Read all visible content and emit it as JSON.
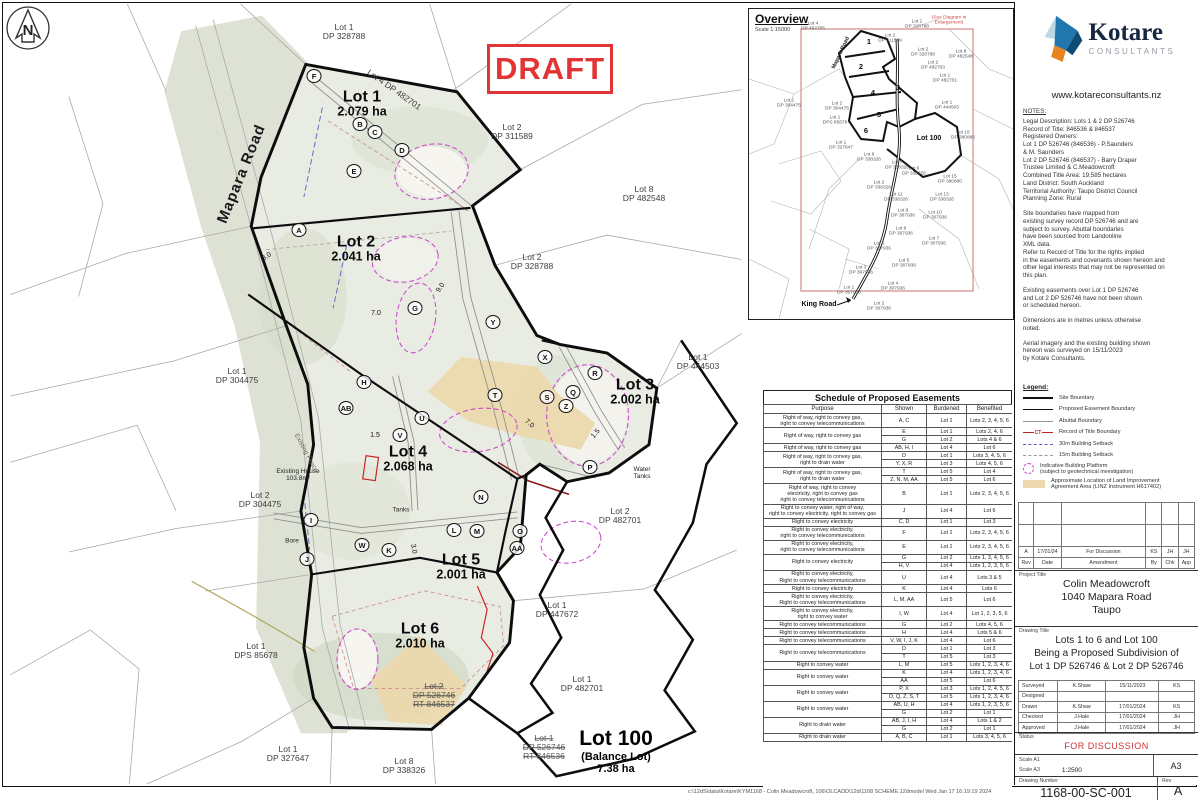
{
  "draft_stamp": "DRAFT",
  "map": {
    "footer_path": "c:\\12dS\\data\\Kotare\\KYM1168 - Colin Meadowcroft, 106\\OLCADD\\12d\\1168 SCHEME.12dmodel   Wed Jan 17 16:19:19 2024",
    "labels": [
      {
        "t": "Lot 1",
        "s": "DP 328788",
        "c": "parcel",
        "x": 340,
        "y": 28
      },
      {
        "t": "Lot 4 DP 482701",
        "c": "edge",
        "x": 390,
        "y": 86,
        "r": 35
      },
      {
        "t": "Lot 1",
        "s": "2.079 ha",
        "c": "lot",
        "x": 358,
        "y": 100
      },
      {
        "t": "Mapara Road",
        "c": "road",
        "x": 238,
        "y": 170,
        "r": -68
      },
      {
        "t": "Lot 2",
        "s": "DP 311589",
        "c": "parcel",
        "x": 508,
        "y": 128
      },
      {
        "t": "Lot 8",
        "s": "DP 482548",
        "c": "parcel",
        "x": 640,
        "y": 190
      },
      {
        "t": "Lot 2",
        "s": "2.041 ha",
        "c": "lot",
        "x": 352,
        "y": 245
      },
      {
        "t": "Lot 2",
        "s": "DP 328788",
        "c": "parcel",
        "x": 528,
        "y": 258
      },
      {
        "t": "Lot 1",
        "s": "DP 304475",
        "c": "parcel",
        "x": 233,
        "y": 372
      },
      {
        "t": "Lot 3",
        "s": "2.002 ha",
        "c": "lot",
        "x": 631,
        "y": 388
      },
      {
        "t": "Lot 1",
        "s": "DP 444503",
        "c": "parcel",
        "x": 694,
        "y": 358
      },
      {
        "t": "Lot 4",
        "s": "2.068 ha",
        "c": "lot",
        "x": 404,
        "y": 455
      },
      {
        "t": "Existing House",
        "s": "103.8m²",
        "c": "tiny",
        "x": 294,
        "y": 471
      },
      {
        "t": "Lot 2",
        "s": "DP 304475",
        "c": "parcel",
        "x": 256,
        "y": 496
      },
      {
        "t": "Water",
        "s": "Tanks",
        "c": "tiny",
        "x": 638,
        "y": 469
      },
      {
        "t": "Lot 2",
        "s": "DP 482701",
        "c": "parcel",
        "x": 616,
        "y": 512
      },
      {
        "t": "Tanks",
        "c": "tiny",
        "x": 397,
        "y": 506
      },
      {
        "t": "Bore",
        "c": "tiny",
        "x": 288,
        "y": 537
      },
      {
        "t": "Lot 5",
        "s": "2.001 ha",
        "c": "lot",
        "x": 457,
        "y": 563
      },
      {
        "t": "Lot 1",
        "s": "DP 447672",
        "c": "parcel",
        "x": 553,
        "y": 606
      },
      {
        "t": "Lot 6",
        "s": "2.010 ha",
        "c": "lot",
        "x": 416,
        "y": 632
      },
      {
        "t": "Lot 1",
        "s": "DPS 85678",
        "c": "parcel",
        "x": 252,
        "y": 647
      },
      {
        "t": "Lot 2",
        "s": "DP 526746\nRT 846537",
        "c": "strike",
        "x": 430,
        "y": 692
      },
      {
        "t": "Lot 1",
        "s": "DP 482701",
        "c": "parcel",
        "x": 578,
        "y": 680
      },
      {
        "t": "Lot 1",
        "s": "DP 526746\nRT 846536",
        "c": "strike",
        "x": 540,
        "y": 744
      },
      {
        "t": "Lot 100",
        "s": "(Balance Lot)\n7.38 ha",
        "c": "lot100",
        "x": 612,
        "y": 748
      },
      {
        "t": "Lot 1",
        "s": "DP 327647",
        "c": "parcel",
        "x": 284,
        "y": 750
      },
      {
        "t": "Lot 8",
        "s": "DP 338326",
        "c": "parcel",
        "x": 400,
        "y": 762
      },
      {
        "t": "Existing Fence",
        "c": "fence",
        "x": 302,
        "y": 449,
        "r": 62
      },
      {
        "t": "8.0",
        "c": "dim",
        "x": 263,
        "y": 253,
        "r": -35
      },
      {
        "t": "9.0",
        "c": "dim",
        "x": 437,
        "y": 284,
        "r": -55
      },
      {
        "t": "7.0",
        "c": "dim",
        "x": 372,
        "y": 310
      },
      {
        "t": "7.0",
        "c": "dim",
        "x": 525,
        "y": 420,
        "r": 40
      },
      {
        "t": "1.5",
        "c": "dim",
        "x": 371,
        "y": 432
      },
      {
        "t": "1.5",
        "c": "dim",
        "x": 592,
        "y": 430,
        "r": -50
      },
      {
        "t": "3.0",
        "c": "dim",
        "x": 409,
        "y": 545,
        "r": 80
      }
    ],
    "markers": [
      [
        "F",
        310,
        72
      ],
      [
        "B",
        356,
        120
      ],
      [
        "C",
        371,
        128
      ],
      [
        "D",
        398,
        146
      ],
      [
        "E",
        350,
        167
      ],
      [
        "A",
        295,
        226
      ],
      [
        "G",
        411,
        304
      ],
      [
        "Y",
        489,
        318
      ],
      [
        "X",
        541,
        353
      ],
      [
        "R",
        591,
        369
      ],
      [
        "Q",
        569,
        388
      ],
      [
        "S",
        543,
        393
      ],
      [
        "Z",
        562,
        402
      ],
      [
        "H",
        360,
        378
      ],
      [
        "AB",
        342,
        404
      ],
      [
        "U",
        418,
        414
      ],
      [
        "V",
        396,
        431
      ],
      [
        "T",
        491,
        391
      ],
      [
        "P",
        586,
        463
      ],
      [
        "I",
        307,
        516
      ],
      [
        "W",
        358,
        541
      ],
      [
        "K",
        385,
        546
      ],
      [
        "L",
        450,
        526
      ],
      [
        "M",
        473,
        527
      ],
      [
        "N",
        477,
        493
      ],
      [
        "O",
        516,
        527
      ],
      [
        "AA",
        513,
        544
      ],
      [
        "J",
        303,
        555
      ]
    ]
  },
  "overview": {
    "title": "Overview",
    "scale": "Scale 1:15000",
    "labels": [
      {
        "t": "(See Diagram in Enlargement)",
        "x": 200,
        "y": 12,
        "c": "red"
      },
      {
        "t": "Lot 4\nDP 482705",
        "x": 64,
        "y": 18
      },
      {
        "t": "Lot 1\nDP 328788",
        "x": 168,
        "y": 16
      },
      {
        "t": "Lot 2\nDP 311589",
        "x": 141,
        "y": 30
      },
      {
        "t": "Lot 2\nDP 328788",
        "x": 174,
        "y": 44
      },
      {
        "t": "Lot 8\nDP 482548",
        "x": 212,
        "y": 46
      },
      {
        "t": "Lot 2\nDP 482703",
        "x": 184,
        "y": 57
      },
      {
        "t": "Lot 1\nDP 482701",
        "x": 196,
        "y": 70
      },
      {
        "t": "Mapara Road",
        "x": 92,
        "y": 44,
        "r": -65,
        "c": "roadsm"
      },
      {
        "t": "Lot 1\nDP 304475",
        "x": 40,
        "y": 95
      },
      {
        "t": "Lot 2\nDP 304475",
        "x": 88,
        "y": 98
      },
      {
        "t": "Lot 1\nDP 444503",
        "x": 198,
        "y": 97
      },
      {
        "t": "Lot 1\nDPS 85678",
        "x": 86,
        "y": 112
      },
      {
        "t": "Lot 100",
        "x": 180,
        "y": 130,
        "c": "bold"
      },
      {
        "t": "Lot 15\nDP 380880",
        "x": 214,
        "y": 127
      },
      {
        "t": "Lot 1\nDP 327647",
        "x": 92,
        "y": 137
      },
      {
        "t": "Lot 8\nDP 338326",
        "x": 120,
        "y": 149
      },
      {
        "t": "Lot 7\nDP 338326",
        "x": 148,
        "y": 157
      },
      {
        "t": "Lot 6\nDP 338326",
        "x": 165,
        "y": 163
      },
      {
        "t": "Lot 15\nDP 380880",
        "x": 201,
        "y": 171
      },
      {
        "t": "Lot 2\nDP 338326",
        "x": 130,
        "y": 177
      },
      {
        "t": "Lot 11\nDP 338326",
        "x": 147,
        "y": 189
      },
      {
        "t": "Lot 13\nDP 338326",
        "x": 193,
        "y": 189
      },
      {
        "t": "Lot 9\nDP 307936",
        "x": 154,
        "y": 205
      },
      {
        "t": "Lot 10\nDP 307936",
        "x": 186,
        "y": 207
      },
      {
        "t": "Lot 8\nDP 307936",
        "x": 152,
        "y": 223
      },
      {
        "t": "Lot 7\nDP 307936",
        "x": 185,
        "y": 233
      },
      {
        "t": "Lot 6\nDP 307936",
        "x": 130,
        "y": 238
      },
      {
        "t": "Lot 5\nDP 307936",
        "x": 155,
        "y": 255
      },
      {
        "t": "Lot 3\nDP 307936",
        "x": 112,
        "y": 262
      },
      {
        "t": "Lot 4\nDP 307936",
        "x": 144,
        "y": 278
      },
      {
        "t": "Lot 1\nDP 307936",
        "x": 100,
        "y": 282
      },
      {
        "t": "Lot 2\nDP 307936",
        "x": 130,
        "y": 298
      },
      {
        "t": "King Road",
        "x": 70,
        "y": 296,
        "c": "bold"
      },
      {
        "t": "1",
        "x": 120,
        "y": 33,
        "c": "num"
      },
      {
        "t": "2",
        "x": 112,
        "y": 58,
        "c": "num"
      },
      {
        "t": "3",
        "x": 149,
        "y": 79,
        "c": "num"
      },
      {
        "t": "4",
        "x": 124,
        "y": 84,
        "c": "num"
      },
      {
        "t": "5",
        "x": 130,
        "y": 106,
        "c": "num"
      },
      {
        "t": "6",
        "x": 117,
        "y": 122,
        "c": "num"
      }
    ]
  },
  "easements": {
    "title": "Schedule of Proposed Easements",
    "columns": [
      "Purpose",
      "Shown",
      "Burdened",
      "Benefited"
    ],
    "groups": [
      {
        "purpose": "Right of way, right to convey gas,\nright to convey telecommunications",
        "rows": [
          [
            "A, C",
            "Lot 1",
            "Lots 2, 3, 4, 5, 6"
          ]
        ]
      },
      {
        "purpose": "Right of way, right to convey gas",
        "rows": [
          [
            "E",
            "Lot 1",
            "Lots 2, 4, 6"
          ],
          [
            "G",
            "Lot 2",
            "Lots 4 & 6"
          ]
        ]
      },
      {
        "purpose": "Right of way, right to convey gas",
        "rows": [
          [
            "AB, H, I",
            "Lot 4",
            "Lot 6"
          ]
        ]
      },
      {
        "purpose": "Right of way, right to convey gas,\nright to drain water",
        "rows": [
          [
            "D",
            "Lot 1",
            "Lots 3, 4, 5, 6"
          ],
          [
            "Y, X, R",
            "Lot 3",
            "Lots 4, 5, 6"
          ]
        ]
      },
      {
        "purpose": "Right of way, right to convey gas,\nright to drain water",
        "rows": [
          [
            "T",
            "Lot 5",
            "Lot 4"
          ],
          [
            "Z, N, M, AA",
            "Lot 5",
            "Lot 6"
          ]
        ]
      },
      {
        "purpose": "Right of way, right to convey\nelectricity, right to convey gas\nright to convey telecommunications",
        "rows": [
          [
            "B",
            "Lot 1",
            "Lots 2, 3, 4, 5, 6"
          ]
        ]
      },
      {
        "purpose": "Right to convey water, right of way,\nright to convey electricity, right to convey gas",
        "rows": [
          [
            "J",
            "Lot 4",
            "Lot 6"
          ]
        ]
      },
      {
        "purpose": "Right to convey electricity",
        "rows": [
          [
            "C, D",
            "Lot 1",
            "Lot 3"
          ]
        ]
      },
      {
        "purpose": "Right to convey electricity,\nright to convey telecommunications",
        "rows": [
          [
            "F",
            "Lot 1",
            "Lots 2, 3, 4, 5, 6"
          ]
        ]
      },
      {
        "purpose": "Right to convey electricity,\nright to convey telecommunications",
        "rows": [
          [
            "E",
            "Lot 1",
            "Lots 2, 3, 4, 5, 6"
          ]
        ]
      },
      {
        "purpose": "Right to convey electricity",
        "rows": [
          [
            "G",
            "Lot 2",
            "Lots 1, 3, 4, 5, 6"
          ],
          [
            "H, V",
            "Lot 4",
            "Lots 1, 2, 3, 5, 6"
          ]
        ]
      },
      {
        "purpose": "Right to convey electricity,\nRight to convey telecommunications",
        "rows": [
          [
            "U",
            "Lot 4",
            "Lots 3 & 5"
          ]
        ]
      },
      {
        "purpose": "Right to convey electricity",
        "rows": [
          [
            "K",
            "Lot 4",
            "Lots 6"
          ]
        ]
      },
      {
        "purpose": "Right to convey electricity,\nRight to convey telecommunications",
        "rows": [
          [
            "L, M, AA",
            "Lot 5",
            "Lot 6"
          ]
        ]
      },
      {
        "purpose": "Right to convey electricity,\nright to convey water",
        "rows": [
          [
            "I, W",
            "Lot 4",
            "Lot 1, 2, 3, 5, 6"
          ]
        ]
      },
      {
        "purpose": "Right to convey telecommunications",
        "rows": [
          [
            "G",
            "Lot 2",
            "Lots 4, 5, 6"
          ]
        ]
      },
      {
        "purpose": "Right to convey telecommunications",
        "rows": [
          [
            "H",
            "Lot 4",
            "Lots 5 & 6"
          ]
        ]
      },
      {
        "purpose": "Right to convey telecommunications",
        "rows": [
          [
            "V, W, I, J, K",
            "Lot 4",
            "Lot 6"
          ]
        ]
      },
      {
        "purpose": "Right to convey telecommunications",
        "rows": [
          [
            "D",
            "Lot 1",
            "Lot 3"
          ],
          [
            "T",
            "Lot 5",
            "Lot 3"
          ]
        ]
      },
      {
        "purpose": "Right to convey water",
        "rows": [
          [
            "L, M",
            "Lot 5",
            "Lots 1, 2, 3, 4, 6"
          ]
        ]
      },
      {
        "purpose": "Right to convey water",
        "rows": [
          [
            "K",
            "Lot 4",
            "Lots 1, 2, 3, 4, 6"
          ],
          [
            "AA",
            "Lot 5",
            "Lot 6"
          ]
        ]
      },
      {
        "purpose": "Right to convey water",
        "rows": [
          [
            "P, X",
            "Lot 3",
            "Lots 1, 2, 4, 5, 6"
          ],
          [
            "O, Q, Z, S, T",
            "Lot 5",
            "Lots 1, 2, 3, 4, 6"
          ]
        ]
      },
      {
        "purpose": "Right to convey water",
        "rows": [
          [
            "AB, U, H",
            "Lot 4",
            "Lots 1, 2, 3, 5, 6"
          ],
          [
            "G",
            "Lot 2",
            "Lot 1"
          ]
        ]
      },
      {
        "purpose": "Right to drain water",
        "rows": [
          [
            "AB, J, I, H",
            "Lot 4",
            "Lots 1 & 2"
          ],
          [
            "G",
            "Lot 2",
            "Lot 1"
          ]
        ]
      },
      {
        "purpose": "Right to drain water",
        "rows": [
          [
            "A, B, C",
            "Lot 1",
            "Lots 3, 4, 5, 6"
          ]
        ]
      }
    ]
  },
  "brand": {
    "name": "Kotare",
    "tagline": "CONSULTANTS",
    "website": "www.kotareconsultants.nz"
  },
  "notes": {
    "title": "NOTES:",
    "paragraphs": [
      "Legal Description: Lots 1 & 2 DP 526746\nRecord of Title: 846536 & 846537\nRegistered Owners:\nLot 1 DP 526746 (846536) - P.Saunders\n& M. Saunders\nLot 2 DP 526746 (846537) - Barry Draper\nTrustee Limited & C.Meadowcroft\nCombined Title Area: 19.585 hectares\nLand District: South Auckland\nTerritorial Authority: Taupo District Council\nPlanning Zone: Rural",
      "Site boundaries have mapped from\nexisting survey record DP 526746 and are\nsubject to survey. Abuttal boundaries\nhave been sourced from Landonline\nXML data.\nRefer to Record of Title for the rights implied\nin the easements and covenants shown hereon and\nother legal interests that may not be represented on\nthis plan.",
      "Existing easements over Lot 1 DP 526746\nand Lot 2 DP 526746 have not been shown\nor scheduled hereon.",
      "Dimensions are in metres unless otherwise\nnoted.",
      "Aerial imagery and the existing building shown\nhereon was surveyed on 15/11/2023\nby Kotare Consultants."
    ]
  },
  "legend": {
    "title": "Legend:",
    "ct_label": "CT",
    "items": [
      {
        "label": "Site Boundary",
        "swatch": "site"
      },
      {
        "label": "Proposed Easement Boundary",
        "swatch": "easement"
      },
      {
        "label": "Abuttal Boundary",
        "swatch": "abuttal"
      },
      {
        "label": "Record of Title Boundary",
        "swatch": "ct"
      },
      {
        "label": "30m Building Setback",
        "swatch": "setback30"
      },
      {
        "label": "15m Building Setback",
        "swatch": "setback15"
      },
      {
        "label": "Indicative Building Platform\n(subject to geotechnical investigation)",
        "swatch": "platform"
      },
      {
        "label": "Approximate Location of Land Improvement\nAgreement Area (LINZ Instrument H617402)",
        "swatch": "lia"
      }
    ]
  },
  "titleblock": {
    "rev_headers": [
      "Rev",
      "Date",
      "Amendment",
      "By",
      "Chk",
      "App"
    ],
    "rev_row": [
      "A",
      "17/01/24",
      "For Discussion",
      "KS",
      "JH",
      "JH"
    ],
    "project_title_label": "Project Title",
    "project_title_lines": [
      "Colin Meadowcroft",
      "1040 Mapara Road",
      "Taupo"
    ],
    "drawing_title_label": "Drawing Title",
    "drawing_title_lines": [
      "Lots 1 to 6 and Lot 100",
      "Being a Proposed Subdivision of",
      "Lot 1 DP 526746 & Lot 2 DP 526746"
    ],
    "signoff": [
      [
        "Surveyed",
        "K.Shaw",
        "15/11/2023",
        "KS"
      ],
      [
        "Designed",
        "",
        "",
        ""
      ],
      [
        "Drawn",
        "K.Shaw",
        "17/01/2024",
        "KS"
      ],
      [
        "Checked",
        "J.Hale",
        "17/01/2024",
        "JH"
      ],
      [
        "Approved",
        "J.Hale",
        "17/01/2024",
        "JH"
      ]
    ],
    "status_label": "Status",
    "status": "FOR DISCUSSION",
    "scale_a1_label": "Scale A1",
    "scale_a1": "",
    "scale_a3_label": "Scale A3",
    "scale_a3": "1:2500",
    "sheet_size": "A3",
    "drawing_number_label": "Drawing Number",
    "drawing_number": "1168-00-SC-001",
    "rev_label": "Rev",
    "rev": "A"
  }
}
